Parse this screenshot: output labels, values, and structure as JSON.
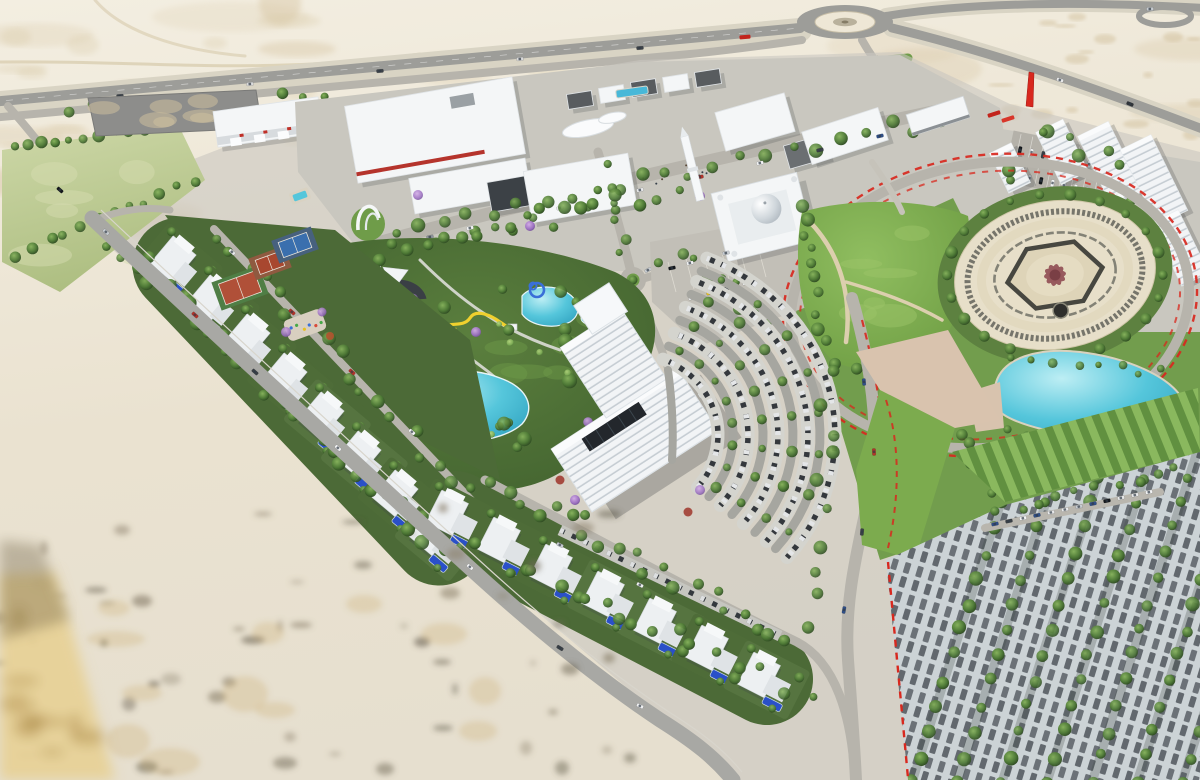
{
  "scene": {
    "title": "Aerial 3D architectural rendering of a desert master-planned community with mosque, water park, office towers, villas and landscaped park",
    "environment": "desert",
    "landmarks": [
      "desert",
      "highway",
      "roundabout",
      "green-field",
      "construction-yard",
      "warehouse",
      "retail-district",
      "boulevard",
      "entry-arch",
      "fountain-pool",
      "mosque",
      "minaret",
      "apartment-district",
      "bus-station",
      "red-monument",
      "central-park",
      "ornamental-plaza",
      "lake",
      "water-park",
      "water-slides",
      "amphitheater-canopies",
      "office-tower-complex",
      "crescent-parking",
      "villa-district",
      "tennis-courts",
      "playground",
      "perimeter-road",
      "parking-field",
      "crop-rows"
    ]
  },
  "palette": {
    "sandTop": "#f1ecdf",
    "sand": "#e9e1cf",
    "sandTan": "#d3bf9a",
    "sandSpeck": "#6f6757",
    "sandWarm": "#e7d197",
    "sandWarmDark": "#b08f4d",
    "asphalt": "#9d9d99",
    "roadLight": "#b7b4ac",
    "shoulder": "#d9d4c4",
    "pavement": "#c9c7bf",
    "grassBright": "#7cab4e",
    "grassMid": "#639540",
    "grassDeep": "#4c6a37",
    "treeDark": "#2e4d22",
    "cypress": "#24431f",
    "jacaranda": "#9b6fc0",
    "pinkTree": "#c88fb8",
    "redTree": "#b0542f",
    "water": "#55c6db",
    "poolBlue": "#2a50c8",
    "white": "#f4f6f7",
    "shade": "#c9ced3",
    "roofDark": "#3c4146",
    "roofGray": "#84888b",
    "red": "#d8281e",
    "plazaCream": "#e7dfc9",
    "plazaDark": "#4a4a44",
    "plazaMaroon": "#96585c",
    "courtRed": "#b05038",
    "courtGreen": "#4f7e45",
    "courtBlue": "#3a6fae",
    "beigePlaza": "#d9c3ae",
    "slideYellow": "#f0d02e",
    "slideBlue": "#3a6fd8",
    "canopy": "#fafbfc"
  }
}
